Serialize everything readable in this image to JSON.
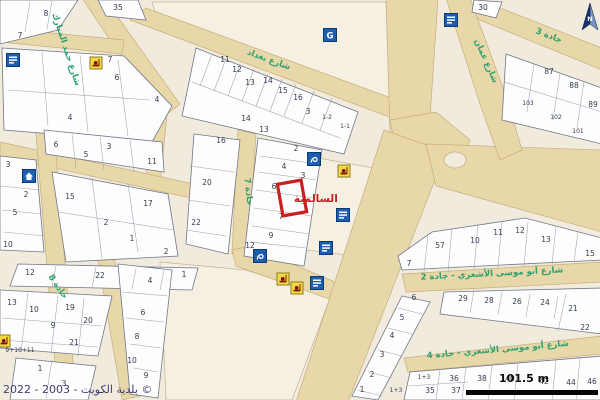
{
  "map": {
    "attribution": "2022 - 2003 - بلدية الكويت ©",
    "scale_label": "101.5 m",
    "north_label": "N",
    "colors": {
      "background": "#f1ebdd",
      "road": "#e8d7a8",
      "parcel_fill": "#fdfdfd",
      "street_label": "#2fa070",
      "selection": "#c81f1f",
      "icon_blue": "#1d5fae",
      "icon_yellow": "#f2d843",
      "scale_bar": "#050505"
    },
    "selection": {
      "cx": 292,
      "cy": 198,
      "w": 24,
      "h": 32,
      "angle": -10,
      "label": "السالمية",
      "lx": 294,
      "ly": 202
    },
    "street_labels": [
      {
        "text": "شارع حمد المبارك",
        "x": 64,
        "y": 50,
        "angle": 72
      },
      {
        "text": "شارع بغداد",
        "x": 268,
        "y": 62,
        "angle": 20
      },
      {
        "text": "شارع عمان",
        "x": 484,
        "y": 62,
        "angle": 66
      },
      {
        "text": "جادة 3",
        "x": 548,
        "y": 38,
        "angle": 21
      },
      {
        "text": "شارع أبو موسى الأشعري - جادة 2",
        "x": 492,
        "y": 276,
        "angle": -3
      },
      {
        "text": "شارع أبو موسى الأشعري - جادة 4",
        "x": 498,
        "y": 352,
        "angle": -5
      },
      {
        "text": "جادة 8",
        "x": 56,
        "y": 288,
        "angle": 55
      },
      {
        "text": "جادة 7",
        "x": 246,
        "y": 192,
        "angle": 84
      }
    ],
    "icons": [
      {
        "kind": "sign",
        "x": 13,
        "y": 60
      },
      {
        "kind": "public-building",
        "x": 330,
        "y": 35
      },
      {
        "kind": "sign",
        "x": 451,
        "y": 20
      },
      {
        "kind": "house",
        "x": 29,
        "y": 176
      },
      {
        "kind": "fountain",
        "x": 314,
        "y": 159
      },
      {
        "kind": "sign",
        "x": 343,
        "y": 215
      },
      {
        "kind": "sign",
        "x": 326,
        "y": 248
      },
      {
        "kind": "fountain",
        "x": 260,
        "y": 256
      },
      {
        "kind": "sign",
        "x": 317,
        "y": 283
      },
      {
        "kind": "mosque",
        "x": 96,
        "y": 63
      },
      {
        "kind": "mosque",
        "x": 344,
        "y": 171
      },
      {
        "kind": "mosque",
        "x": 283,
        "y": 279
      },
      {
        "kind": "mosque",
        "x": 297,
        "y": 288
      },
      {
        "kind": "mosque",
        "x": 4,
        "y": 341
      }
    ],
    "parcels": [
      {
        "n": "8",
        "x": 46,
        "y": 16
      },
      {
        "n": "7",
        "x": 20,
        "y": 38
      },
      {
        "n": "35",
        "x": 118,
        "y": 10
      },
      {
        "n": "7",
        "x": 110,
        "y": 62
      },
      {
        "n": "6",
        "x": 117,
        "y": 80
      },
      {
        "n": "4",
        "x": 157,
        "y": 102
      },
      {
        "n": "4",
        "x": 70,
        "y": 120
      },
      {
        "n": "11",
        "x": 225,
        "y": 62
      },
      {
        "n": "12",
        "x": 237,
        "y": 72
      },
      {
        "n": "13",
        "x": 250,
        "y": 85
      },
      {
        "n": "14",
        "x": 268,
        "y": 83
      },
      {
        "n": "15",
        "x": 283,
        "y": 93
      },
      {
        "n": "16",
        "x": 298,
        "y": 100
      },
      {
        "n": "3",
        "x": 308,
        "y": 114
      },
      {
        "n": "1-2",
        "x": 327,
        "y": 119
      },
      {
        "n": "1-1",
        "x": 345,
        "y": 128
      },
      {
        "n": "14",
        "x": 246,
        "y": 121
      },
      {
        "n": "13",
        "x": 264,
        "y": 132
      },
      {
        "n": "16",
        "x": 221,
        "y": 143
      },
      {
        "n": "20",
        "x": 207,
        "y": 185
      },
      {
        "n": "22",
        "x": 196,
        "y": 225
      },
      {
        "n": "2",
        "x": 296,
        "y": 151
      },
      {
        "n": "4",
        "x": 284,
        "y": 169
      },
      {
        "n": "3",
        "x": 303,
        "y": 178
      },
      {
        "n": "6",
        "x": 274,
        "y": 189
      },
      {
        "n": "7",
        "x": 281,
        "y": 219
      },
      {
        "n": "9",
        "x": 271,
        "y": 238
      },
      {
        "n": "12",
        "x": 250,
        "y": 248
      },
      {
        "n": "6",
        "x": 56,
        "y": 147
      },
      {
        "n": "3",
        "x": 109,
        "y": 149
      },
      {
        "n": "5",
        "x": 86,
        "y": 157
      },
      {
        "n": "11",
        "x": 152,
        "y": 164
      },
      {
        "n": "15",
        "x": 70,
        "y": 199
      },
      {
        "n": "17",
        "x": 148,
        "y": 206
      },
      {
        "n": "2",
        "x": 106,
        "y": 225
      },
      {
        "n": "1",
        "x": 132,
        "y": 241
      },
      {
        "n": "2",
        "x": 166,
        "y": 254
      },
      {
        "n": "3",
        "x": 8,
        "y": 167
      },
      {
        "n": "2",
        "x": 26,
        "y": 197
      },
      {
        "n": "5",
        "x": 15,
        "y": 215
      },
      {
        "n": "10",
        "x": 8,
        "y": 247
      },
      {
        "n": "12",
        "x": 30,
        "y": 275
      },
      {
        "n": "22",
        "x": 100,
        "y": 278
      },
      {
        "n": "1",
        "x": 184,
        "y": 277
      },
      {
        "n": "13",
        "x": 12,
        "y": 305
      },
      {
        "n": "10",
        "x": 34,
        "y": 312
      },
      {
        "n": "19",
        "x": 70,
        "y": 310
      },
      {
        "n": "9",
        "x": 53,
        "y": 328
      },
      {
        "n": "20",
        "x": 88,
        "y": 323
      },
      {
        "n": "21",
        "x": 74,
        "y": 345
      },
      {
        "n": "1",
        "x": 40,
        "y": 371
      },
      {
        "n": "3",
        "x": 64,
        "y": 386
      },
      {
        "n": "4",
        "x": 150,
        "y": 283
      },
      {
        "n": "6",
        "x": 143,
        "y": 315
      },
      {
        "n": "8",
        "x": 137,
        "y": 339
      },
      {
        "n": "10",
        "x": 132,
        "y": 363
      },
      {
        "n": "9",
        "x": 146,
        "y": 378
      },
      {
        "n": "30",
        "x": 483,
        "y": 10
      },
      {
        "n": "87",
        "x": 549,
        "y": 74
      },
      {
        "n": "88",
        "x": 574,
        "y": 88
      },
      {
        "n": "89",
        "x": 593,
        "y": 107
      },
      {
        "n": "103",
        "x": 528,
        "y": 105
      },
      {
        "n": "102",
        "x": 556,
        "y": 119
      },
      {
        "n": "101",
        "x": 578,
        "y": 133
      },
      {
        "n": "7",
        "x": 409,
        "y": 266
      },
      {
        "n": "57",
        "x": 440,
        "y": 248
      },
      {
        "n": "10",
        "x": 475,
        "y": 243
      },
      {
        "n": "11",
        "x": 498,
        "y": 235
      },
      {
        "n": "12",
        "x": 520,
        "y": 233
      },
      {
        "n": "13",
        "x": 546,
        "y": 242
      },
      {
        "n": "15",
        "x": 590,
        "y": 256
      },
      {
        "n": "29",
        "x": 463,
        "y": 301
      },
      {
        "n": "28",
        "x": 489,
        "y": 303
      },
      {
        "n": "26",
        "x": 517,
        "y": 304
      },
      {
        "n": "24",
        "x": 545,
        "y": 305
      },
      {
        "n": "21",
        "x": 573,
        "y": 311
      },
      {
        "n": "22",
        "x": 585,
        "y": 330
      },
      {
        "n": "1+3",
        "x": 424,
        "y": 379
      },
      {
        "n": "35",
        "x": 430,
        "y": 393
      },
      {
        "n": "36",
        "x": 454,
        "y": 381
      },
      {
        "n": "37",
        "x": 456,
        "y": 393
      },
      {
        "n": "38",
        "x": 482,
        "y": 381
      },
      {
        "n": "40",
        "x": 510,
        "y": 381
      },
      {
        "n": "42",
        "x": 544,
        "y": 384
      },
      {
        "n": "44",
        "x": 571,
        "y": 385
      },
      {
        "n": "46",
        "x": 592,
        "y": 384
      },
      {
        "n": "6",
        "x": 414,
        "y": 300
      },
      {
        "n": "5",
        "x": 402,
        "y": 320
      },
      {
        "n": "4",
        "x": 392,
        "y": 338
      },
      {
        "n": "3",
        "x": 382,
        "y": 357
      },
      {
        "n": "2",
        "x": 372,
        "y": 377
      },
      {
        "n": "1",
        "x": 362,
        "y": 392
      },
      {
        "n": "1+3",
        "x": 396,
        "y": 392
      },
      {
        "n": "9+10+11",
        "x": 20,
        "y": 352
      }
    ]
  }
}
